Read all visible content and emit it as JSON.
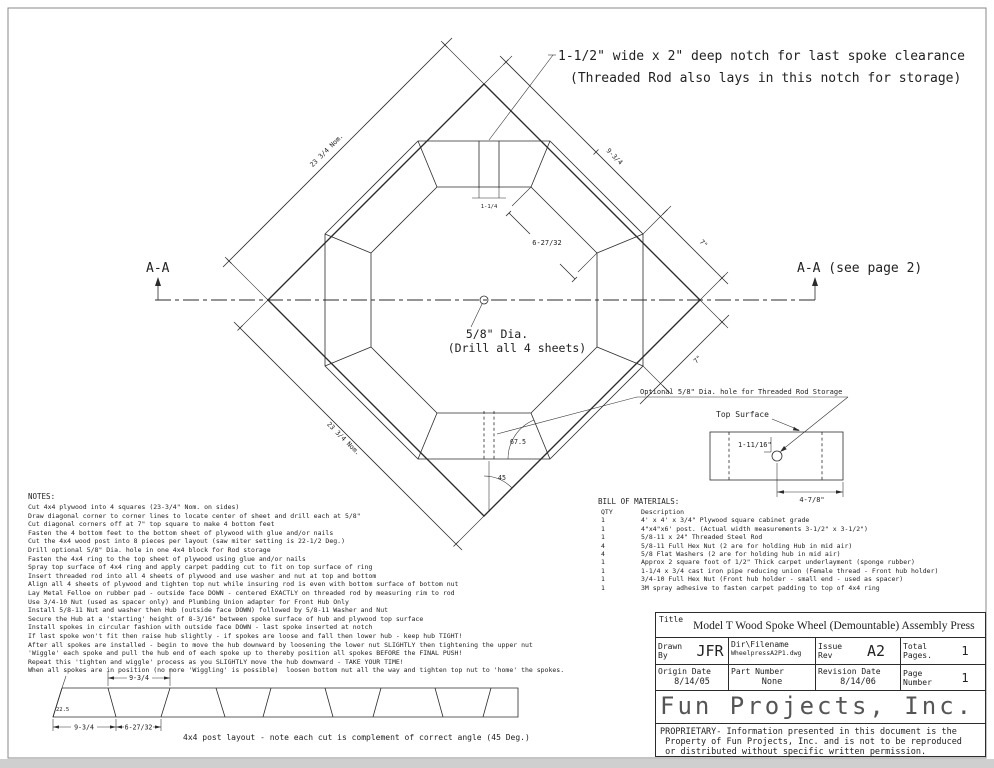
{
  "annotations": {
    "notch_note_line1": "1-1/2\" wide x 2\" deep notch for last spoke clearance",
    "notch_note_line2": "(Threaded Rod also lays in this notch for storage)",
    "section_left": "A-A",
    "section_right": "A-A (see page 2)",
    "center_hole_line1": "5/8\" Dia.",
    "center_hole_line2": "(Drill all 4 sheets)",
    "optional_hole": "Optional 5/8\" Dia. hole for Threaded Rod Storage",
    "top_surface": "Top Surface"
  },
  "dimensions": {
    "side_upper_left": "23 3/4 Nom.",
    "side_lower_left": "23 3/4 Nom.",
    "block_outer": "9-3/4",
    "corner_upper": "7\"",
    "corner_lower": "7\"",
    "block_inner": "6-27/32",
    "notch_width": "1-1/4",
    "angle_block": "67.5",
    "angle_corner": "45",
    "detail_hole_depth": "1-11/16\"",
    "detail_hole_offset": "4-7/8\""
  },
  "post_layout": {
    "dim_top": "9-3/4",
    "dim_bottom_left": "9-3/4",
    "dim_bottom_right": "6-27/32",
    "angle": "22.5",
    "caption": "4x4 post layout - note each cut is complement of correct angle (45 Deg.)"
  },
  "notes": {
    "title": "NOTES:",
    "lines": [
      "Cut 4x4 plywood into 4 squares (23-3/4\" Nom. on sides)",
      "Draw diagonal corner to corner lines to locate center of sheet and drill each at 5/8\"",
      "Cut diagonal corners off at 7\" top square to make 4 bottom feet",
      "Fasten the 4 bottom feet to the bottom sheet of plywood with glue and/or nails",
      "Cut the 4x4 wood post into 8 pieces per layout (saw miter setting is 22-1/2 Deg.)",
      "Drill optional 5/8\" Dia. hole in one 4x4 block for Rod storage",
      "Fasten the 4x4 ring to the top sheet of plywood using glue and/or nails",
      "Spray top surface of 4x4 ring and apply carpet padding cut to fit on top surface of ring",
      "Insert threaded rod into all 4 sheets of plywood and use washer and nut at top and bottom",
      "Align all 4 sheets of plywood and tighten top nut while insuring rod is even with bottom surface of bottom nut",
      "Lay Metal Felloe on rubber pad - outside face DOWN - centered EXACTLY on threaded rod by measuring rim to rod",
      "Use 3/4-10 Nut (used as spacer only) and Plumbing Union adapter for Front Hub Only",
      "Install 5/8-11 Nut and washer then Hub (outside face DOWN) followed by 5/8-11 Washer and Nut",
      "Secure the Hub at a 'starting' height of 8-3/16\" between spoke surface of hub and plywood top surface",
      "Install spokes in circular fashion with outside face DOWN - last spoke inserted at notch",
      "If last spoke won't fit then raise hub slightly - if spokes are loose and fall then lower hub - keep hub TIGHT!",
      "After all spokes are installed - begin to move the hub downward by loosening the lower nut SLIGHTLY then tightening the upper nut",
      "'Wiggle' each spoke and pull the hub end of each spoke up to thereby position all spokes BEFORE the FINAL PUSH!",
      "Repeat this 'tighten and wiggle' process as you SLIGHTLY move the hub downward - TAKE YOUR TIME!",
      "When all spokes are in position (no more 'Wiggling' is possible)  loosen bottom nut all the way and tighten top nut to 'home' the spokes."
    ]
  },
  "bom": {
    "title": "BILL OF MATERIALS:",
    "qty_header": "QTY",
    "desc_header": "Description",
    "rows": [
      {
        "qty": "1",
        "desc": "4' x 4' x 3/4\" Plywood square cabinet grade"
      },
      {
        "qty": "1",
        "desc": "4\"x4\"x6' post. (Actual width measurements 3-1/2\" x 3-1/2\")"
      },
      {
        "qty": "1",
        "desc": "5/8-11 x 24\" Threaded Steel Rod"
      },
      {
        "qty": "4",
        "desc": "5/8-11 Full Hex Nut (2 are for holding Hub in mid air)"
      },
      {
        "qty": "4",
        "desc": "5/8 Flat Washers (2 are for holding hub in mid air)"
      },
      {
        "qty": "1",
        "desc": "Approx 2 square foot of 1/2\" Thick carpet underlayment (sponge rubber)"
      },
      {
        "qty": "1",
        "desc": "1-1/4 x 3/4 cast iron pipe reducing union (Female thread - Front hub holder)"
      },
      {
        "qty": "1",
        "desc": "3/4-10 Full Hex Nut (Front hub holder - small end - used as spacer)"
      },
      {
        "qty": "1",
        "desc": "3M spray adhesive to fasten carpet padding to top of 4x4 ring"
      }
    ]
  },
  "title_block": {
    "title_label": "Title",
    "title": "Model T Wood Spoke Wheel (Demountable) Assembly Press",
    "drawn_by_label": "Drawn By",
    "drawn_by": "JFR",
    "filename_label": "Dir\\Filename",
    "filename": "WheelpressA2P1.dwg",
    "issue_label": "Issue Rev",
    "issue": "A2",
    "total_pages_label": "Total Pages.",
    "total_pages": "1",
    "origin_label": "Origin Date",
    "origin_date": "8/14/05",
    "part_label": "Part Number",
    "part_number": "None",
    "revision_label": "Revision Date",
    "revision_date": "8/14/06",
    "page_label": "Page Number",
    "page_number": "1",
    "company": "Fun Projects, Inc.",
    "proprietary": [
      "PROPRIETARY- Information presented in this document is the",
      " Property of Fun Projects, Inc. and is not to be reproduced",
      " or distributed without specific written permission."
    ]
  }
}
